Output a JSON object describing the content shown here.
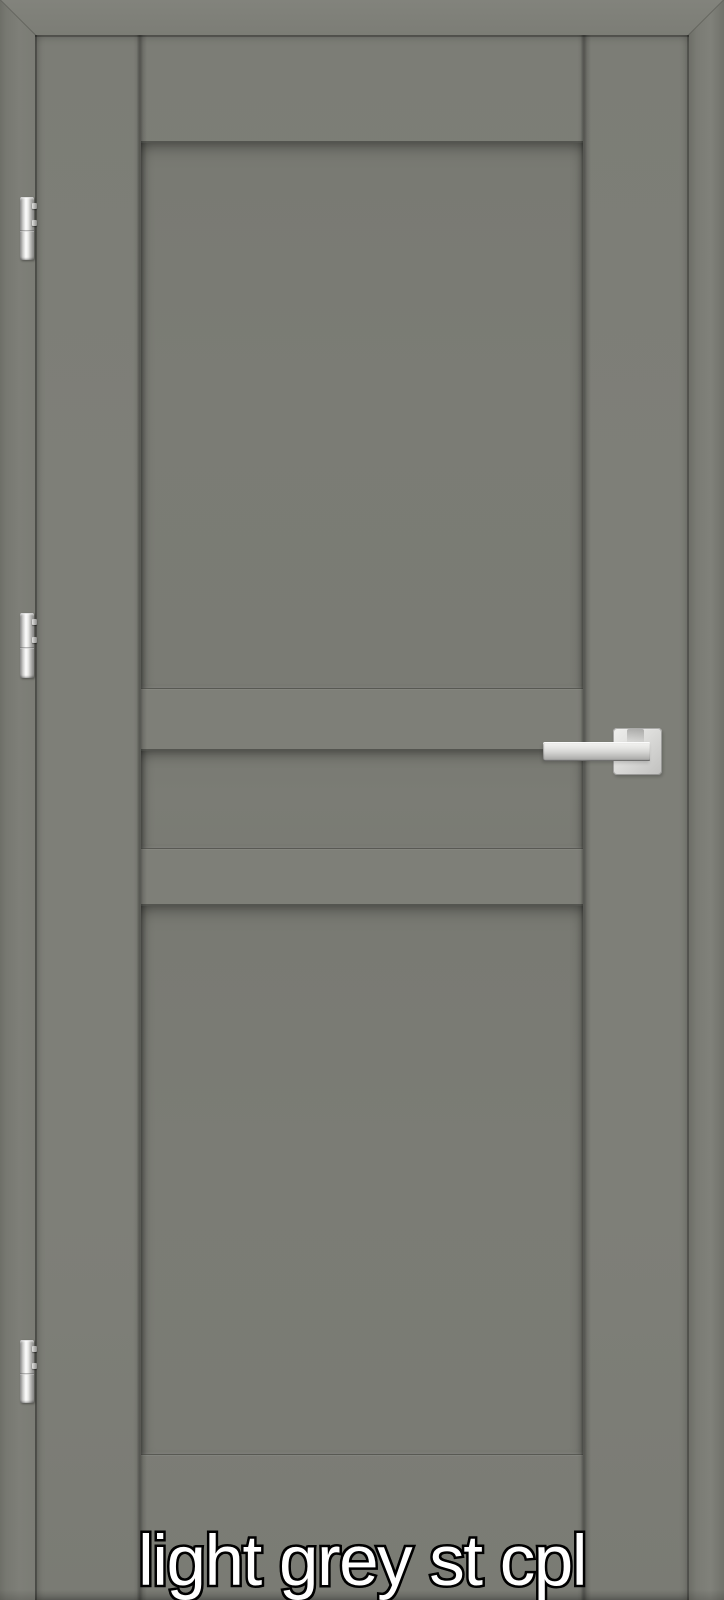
{
  "caption": {
    "text": "light grey st cpl",
    "fill_color": "#ffffff",
    "outline_color": "#000000"
  },
  "door": {
    "description": "interior door leaf with three recessed flat panels, shown closed inside its frame",
    "finish_color": "#7e7f78",
    "panel_recess_color": "#7a7b74",
    "frame_color": "#7c7d76",
    "seam_shadow_color": "#5f6059",
    "panel_sections": [
      "upper-panel",
      "middle-strip-panel",
      "lower-panel"
    ]
  },
  "hardware": {
    "finish": "brushed chrome",
    "chrome_color": "#dcdcda",
    "handle": {
      "type": "straight lever handle",
      "rosette": "square"
    },
    "hinges": [
      {
        "position": "top"
      },
      {
        "position": "middle"
      },
      {
        "position": "bottom"
      }
    ]
  }
}
